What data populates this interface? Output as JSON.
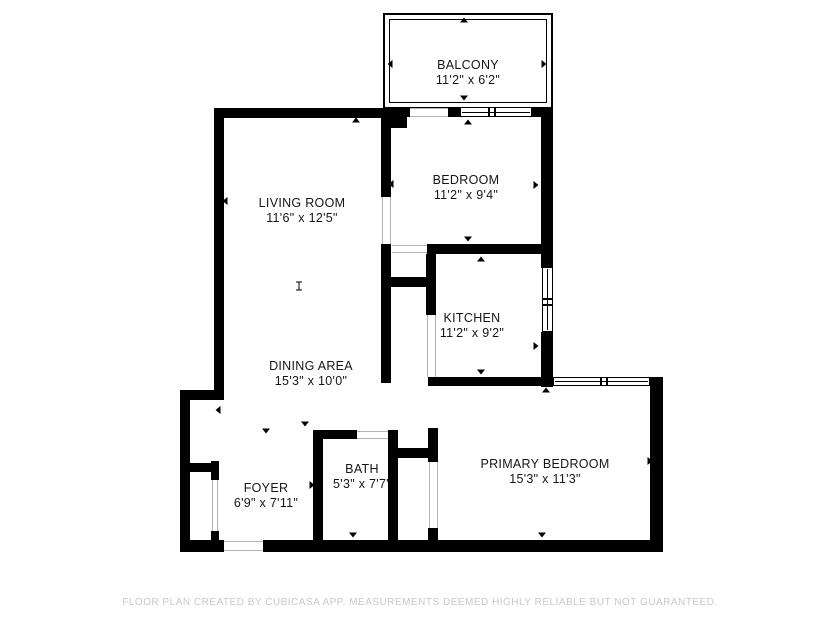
{
  "footer": {
    "text": "FLOOR PLAN CREATED BY CUBICASA APP. MEASUREMENTS DEEMED HIGHLY RELIABLE BUT NOT GUARANTEED."
  },
  "colors": {
    "wall": "#000000",
    "background": "#ffffff",
    "footer_text": "#c8c8c8",
    "opening_line": "#b4b4b4",
    "label_text": "#161616"
  },
  "rooms": [
    {
      "id": "balcony",
      "name": "BALCONY",
      "dims": "11'2\" x 6'2\""
    },
    {
      "id": "bedroom",
      "name": "BEDROOM",
      "dims": "11'2\" x 9'4\""
    },
    {
      "id": "living-room",
      "name": "LIVING ROOM",
      "dims": "11'6\" x 12'5\""
    },
    {
      "id": "kitchen",
      "name": "KITCHEN",
      "dims": "11'2\" x 9'2\""
    },
    {
      "id": "dining-area",
      "name": "DINING AREA",
      "dims": "15'3\" x 10'0\""
    },
    {
      "id": "foyer",
      "name": "FOYER",
      "dims": "6'9\" x 7'11\""
    },
    {
      "id": "bath",
      "name": "BATH",
      "dims": "5'3\" x 7'7\""
    },
    {
      "id": "primary-bedroom",
      "name": "PRIMARY BEDROOM",
      "dims": "15'3\" x 11'3\""
    }
  ],
  "plan": {
    "railing": {
      "outer": [
        383,
        13,
        170,
        96
      ],
      "inner": [
        389,
        19,
        158,
        84
      ]
    },
    "walls": [
      [
        214,
        108,
        180,
        10
      ],
      [
        381,
        108,
        26,
        20
      ],
      [
        214,
        108,
        10,
        290
      ],
      [
        180,
        390,
        44,
        10
      ],
      [
        180,
        390,
        10,
        162
      ],
      [
        180,
        540,
        44,
        12
      ],
      [
        263,
        540,
        400,
        12
      ],
      [
        650,
        377,
        13,
        175
      ],
      [
        428,
        377,
        125,
        9
      ],
      [
        541,
        107,
        12,
        161
      ],
      [
        541,
        332,
        12,
        55
      ],
      [
        427,
        244,
        126,
        10
      ],
      [
        381,
        118,
        10,
        79
      ],
      [
        381,
        244,
        10,
        139
      ],
      [
        381,
        277,
        55,
        10
      ],
      [
        426,
        254,
        10,
        61
      ],
      [
        313,
        430,
        10,
        110
      ],
      [
        388,
        430,
        10,
        110
      ],
      [
        313,
        430,
        44,
        9
      ],
      [
        398,
        448,
        30,
        10
      ],
      [
        428,
        428,
        10,
        34
      ],
      [
        428,
        528,
        10,
        12
      ],
      [
        186,
        463,
        32,
        9
      ],
      [
        211,
        461,
        8,
        19
      ],
      [
        211,
        531,
        8,
        11
      ],
      [
        383,
        107,
        27,
        10
      ],
      [
        448,
        107,
        12,
        10
      ],
      [
        532,
        107,
        21,
        10
      ]
    ],
    "windows": [
      {
        "rect": [
          460,
          107,
          72,
          10
        ],
        "orient": "h",
        "dividers": [
          487,
          493
        ]
      },
      {
        "rect": [
          542,
          267,
          11,
          65
        ],
        "orient": "v",
        "dividers": [
          297,
          303
        ]
      },
      {
        "rect": [
          553,
          377,
          97,
          9
        ],
        "orient": "h",
        "dividers": [
          599,
          605
        ]
      }
    ],
    "openings": [
      {
        "rect": [
          407,
          108,
          41,
          9
        ],
        "orient": "h"
      },
      {
        "rect": [
          382,
          197,
          9,
          47
        ],
        "orient": "v"
      },
      {
        "rect": [
          392,
          245,
          35,
          8
        ],
        "orient": "h"
      },
      {
        "rect": [
          429,
          462,
          9,
          66
        ],
        "orient": "v"
      },
      {
        "rect": [
          357,
          431,
          31,
          8
        ],
        "orient": "h"
      },
      {
        "rect": [
          224,
          541,
          39,
          10
        ],
        "orient": "h"
      },
      {
        "rect": [
          212,
          480,
          6,
          51
        ],
        "orient": "v"
      },
      {
        "rect": [
          427,
          315,
          9,
          62
        ],
        "orient": "v"
      }
    ],
    "ticks": [
      [
        356,
        120,
        "up"
      ],
      [
        225,
        201,
        "left"
      ],
      [
        299,
        286,
        "ibar"
      ],
      [
        464,
        20,
        "up"
      ],
      [
        390,
        64,
        "left"
      ],
      [
        544,
        64,
        "right"
      ],
      [
        464,
        98,
        "down"
      ],
      [
        468,
        122,
        "up"
      ],
      [
        391,
        184,
        "left"
      ],
      [
        536,
        185,
        "right"
      ],
      [
        468,
        239,
        "down"
      ],
      [
        481,
        259,
        "up"
      ],
      [
        536,
        346,
        "right"
      ],
      [
        481,
        372,
        "down"
      ],
      [
        218,
        410,
        "left"
      ],
      [
        266,
        431,
        "down"
      ],
      [
        305,
        424,
        "down"
      ],
      [
        650,
        461,
        "right"
      ],
      [
        542,
        535,
        "down"
      ],
      [
        546,
        390,
        "up"
      ],
      [
        353,
        535,
        "down"
      ],
      [
        312,
        485,
        "right"
      ],
      [
        394,
        484,
        "left"
      ]
    ]
  }
}
